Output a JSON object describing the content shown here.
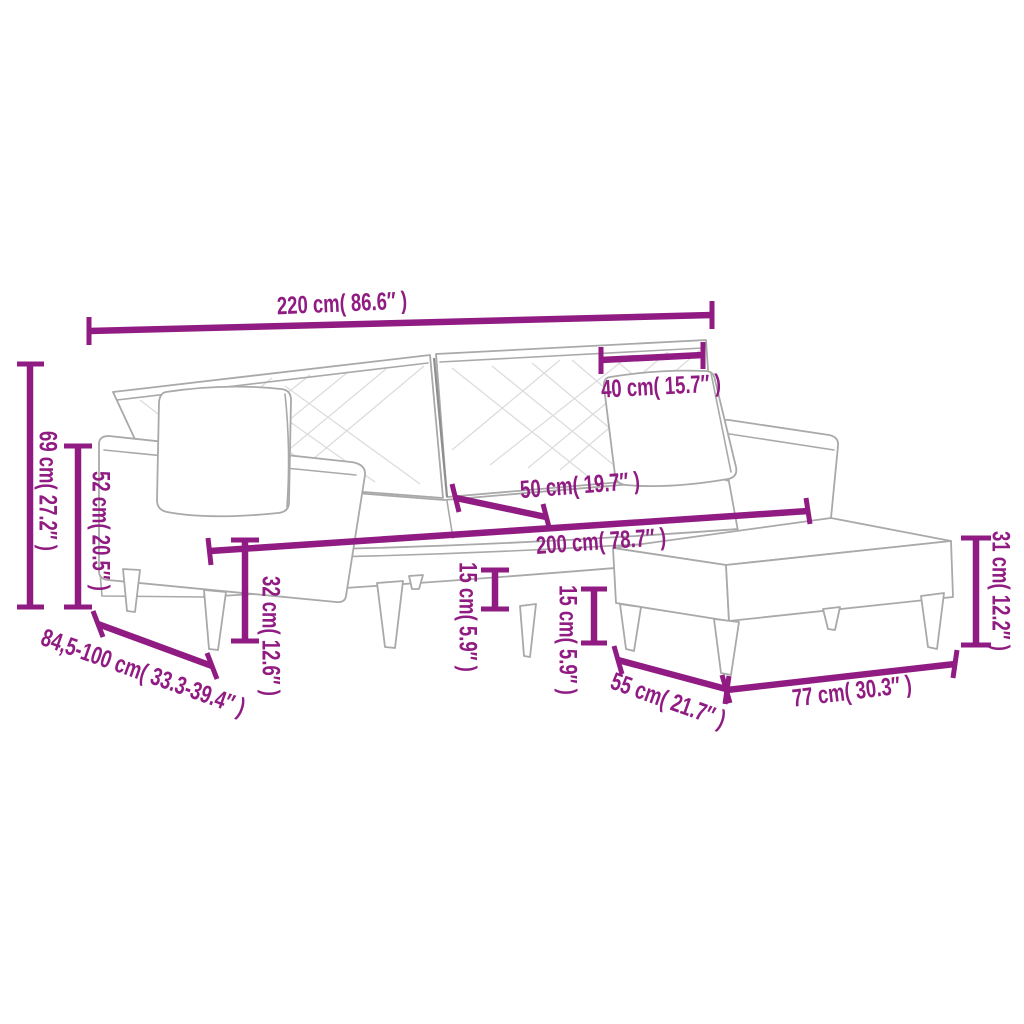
{
  "theme": {
    "accent": "#901b82",
    "sketch": "#a9a9a9",
    "hatch": "#dcdcdc",
    "background": "#ffffff"
  },
  "diagram": {
    "kind": "product-dimension-diagram",
    "product": "2-seater sofa bed with pillows and footstool",
    "labels": {
      "overall_width": "220 cm( 86.6″ )",
      "back_cushion_width": "40 cm( 15.7″ )",
      "overall_height": "69 cm( 27.2″ )",
      "armrest_height": "52 cm( 20.5″ )",
      "depth_range": "84,5-100 cm( 33.3-39.4″ )",
      "seat_width": "200 cm( 78.7″ )",
      "seat_depth": "50 cm( 19.7″ )",
      "seat_height": "32 cm( 12.6″ )",
      "sofa_leg_height": "15 cm( 5.9″ )",
      "footstool_leg_height": "15 cm( 5.9″ )",
      "footstool_depth": "55 cm( 21.7″ )",
      "footstool_width": "77 cm( 30.3″ )",
      "footstool_height": "31 cm( 12.2″ )"
    }
  }
}
